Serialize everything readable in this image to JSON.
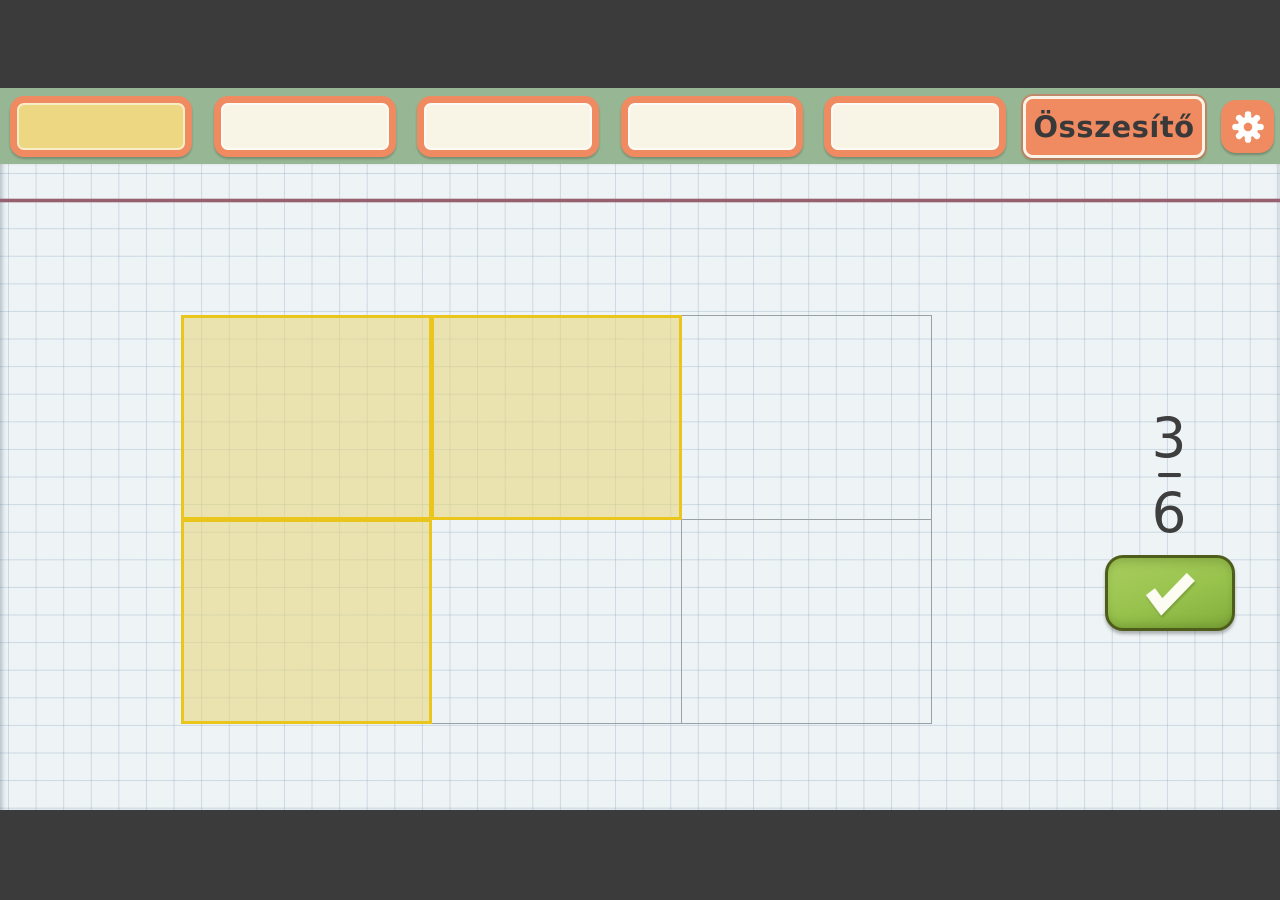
{
  "toolbar": {
    "tabs": [
      {
        "label": "",
        "active": true
      },
      {
        "label": "",
        "active": false
      },
      {
        "label": "",
        "active": false
      },
      {
        "label": "",
        "active": false
      },
      {
        "label": "",
        "active": false
      }
    ],
    "summary_label": "Összesítő",
    "icons": {
      "settings": "gear-icon"
    }
  },
  "exercise": {
    "type": "fraction-shading",
    "rows": 2,
    "cols": 3,
    "total_parts": 6,
    "shaded_parts": 3,
    "cells": [
      {
        "row": 0,
        "col": 0,
        "shaded": true
      },
      {
        "row": 0,
        "col": 1,
        "shaded": true
      },
      {
        "row": 0,
        "col": 2,
        "shaded": false
      },
      {
        "row": 1,
        "col": 0,
        "shaded": true
      },
      {
        "row": 1,
        "col": 1,
        "shaded": false
      },
      {
        "row": 1,
        "col": 2,
        "shaded": false
      }
    ]
  },
  "fraction": {
    "numerator": "3",
    "denominator": "6"
  },
  "check_button": {
    "icon": "check-icon"
  },
  "colors": {
    "frame_dark": "#3b3b3b",
    "toolbar_green": "#97b794",
    "tab_border_salmon": "#ef8a61",
    "tab_active_yellow": "#eed783",
    "tab_cream": "#f8f5e7",
    "paper_blue_white": "#eef3f6",
    "margin_line_red": "#96606e",
    "shaded_cell_border": "#eac61c",
    "shaded_cell_fill": "#e7d676",
    "unshaded_cell_border": "#98a1a6",
    "check_green": "#97c24c",
    "fraction_text": "#3e3e3e"
  }
}
